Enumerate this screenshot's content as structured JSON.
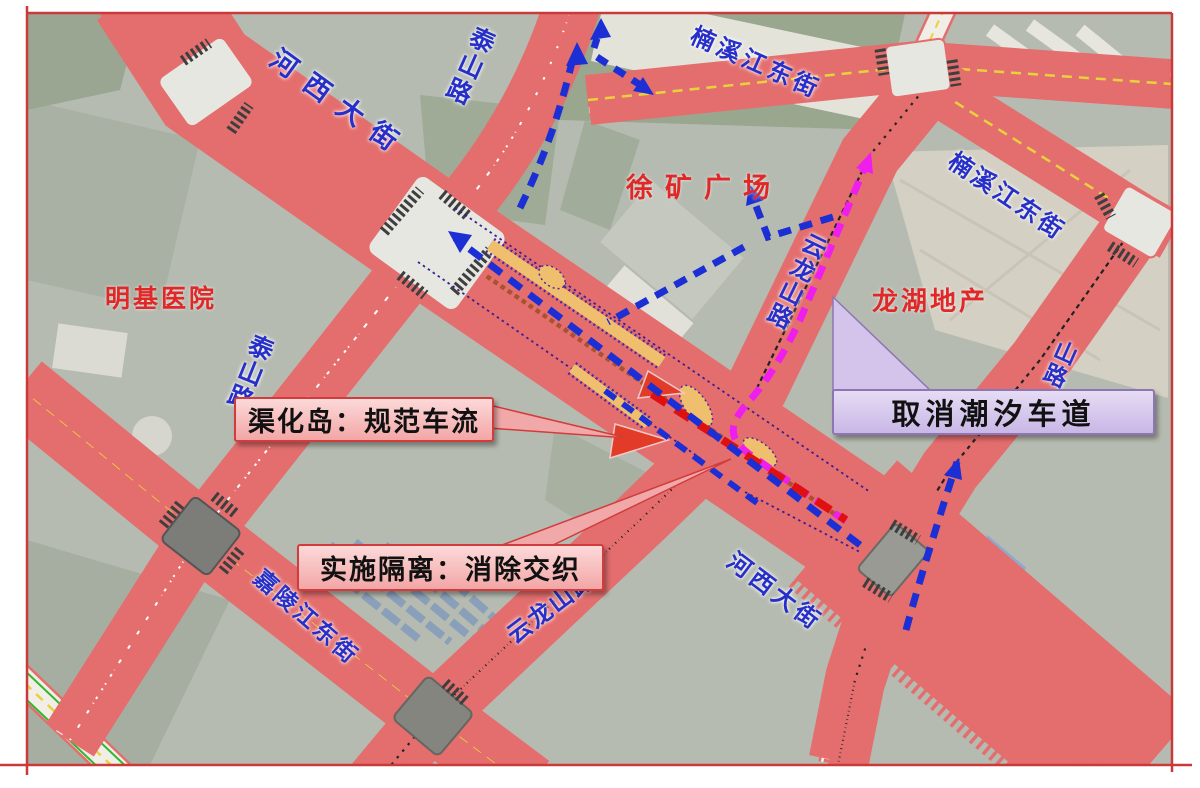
{
  "streets": {
    "hexi_top": "河西大街",
    "hexi_bottom": "河西大街",
    "taishan_top": "泰山路",
    "taishan_left": "泰山路",
    "nanxi_top": "楠溪江东街",
    "nanxi_right": "楠溪江东街",
    "yunlong_upper": "云龙山路",
    "yunlong_lower": "云龙山路",
    "jialing": "嘉陵江东街",
    "lushan_fragment": "山路"
  },
  "places": {
    "xukuang_square": "徐矿广场",
    "longhu_real_estate": "龙湖地产",
    "mingji_hospital": "明基医院"
  },
  "callouts": {
    "channelization_island": "渠化岛：规范车流",
    "separation": "实施隔离：消除交织",
    "tidal_lane": "取消潮汐车道"
  },
  "colors": {
    "street_label": "#2630c8",
    "place_label": "#e02828",
    "callout_pink_fill": "#f6b6b6",
    "callout_pink_border": "#d23c3c",
    "callout_purple_fill": "#d5c6ea",
    "callout_purple_border": "#8e76b4",
    "route_blue": "#1b2fd4",
    "route_magenta": "#ee1eee",
    "route_red": "#e01010",
    "island_orange": "#f0bf6e",
    "island_red": "#e23b28",
    "frame_border": "#c93a3a"
  }
}
